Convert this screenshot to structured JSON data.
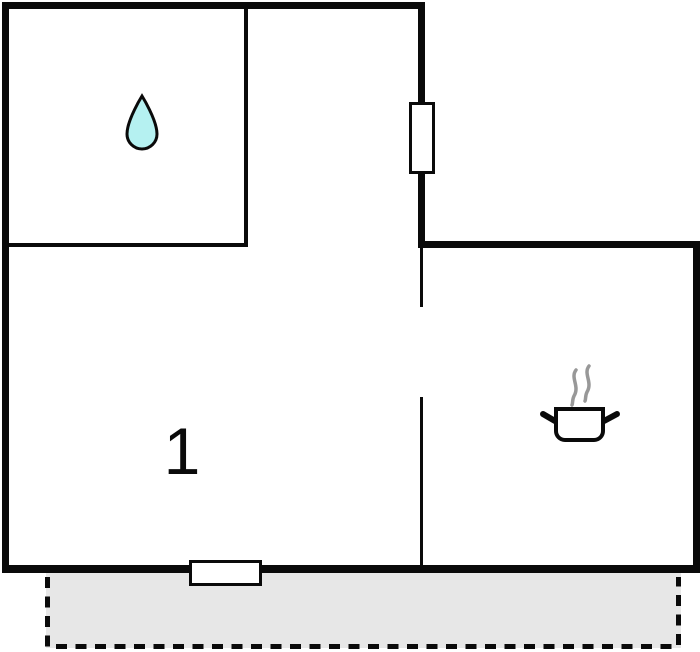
{
  "plan": {
    "type": "floor-plan",
    "room_label": "1",
    "colors": {
      "wall": "#0a0a0a",
      "background": "#ffffff",
      "drop_fill": "#b5f1f1",
      "terrace_fill": "#e7e7e7",
      "steam": "#989898"
    },
    "icons": {
      "bathroom": "water-drop-icon",
      "kitchen": "cooking-pot-icon",
      "kitchen_steam": "steam-icon"
    },
    "features": {
      "top_window": "window",
      "bottom_door": "window-door",
      "partition_gap": "door-opening",
      "terrace": "terrace (dashed outline)"
    }
  }
}
